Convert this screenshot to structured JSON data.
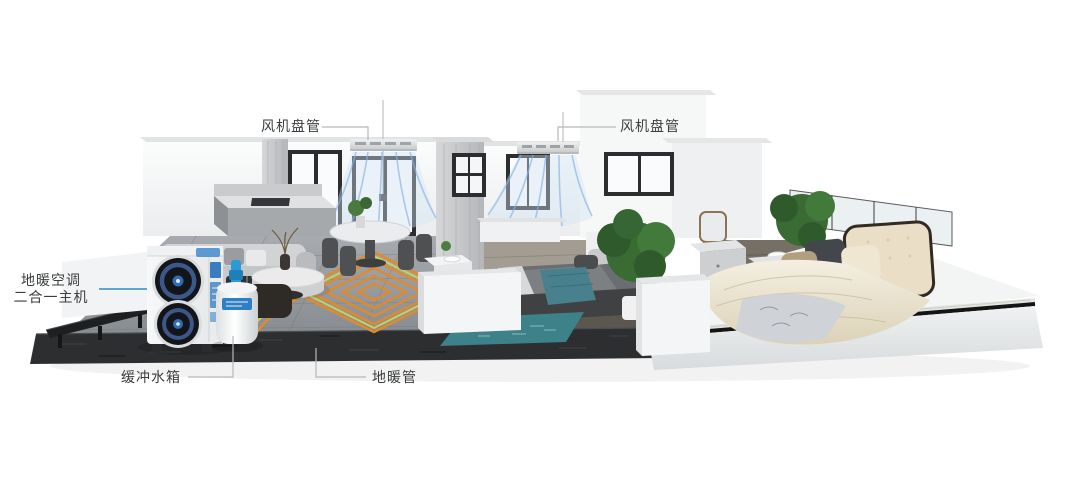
{
  "callouts": {
    "fan_coil_left": {
      "label": "风机盘管"
    },
    "fan_coil_right": {
      "label": "风机盘管"
    },
    "main_unit": {
      "label_line1": "地暖空调",
      "label_line2": "二合一主机"
    },
    "buffer_tank": {
      "label": "缓冲水箱"
    },
    "floor_heating_pipe": {
      "label": "地暖管"
    }
  },
  "colors": {
    "label_text": "#3b3d3f",
    "leader_line_gray": "#b6b8ba",
    "leader_line_blue": "#2e8ec5",
    "pipe_orange": "#e08a2e",
    "pipe_green": "#cbd052",
    "airflow_blue": "#86b3e2",
    "unit_accent_blue": "#2f7fc4",
    "base_slab": "#2c2e30",
    "tile_floor": "#9aa0a5",
    "rug_teal": "#3e8289"
  }
}
